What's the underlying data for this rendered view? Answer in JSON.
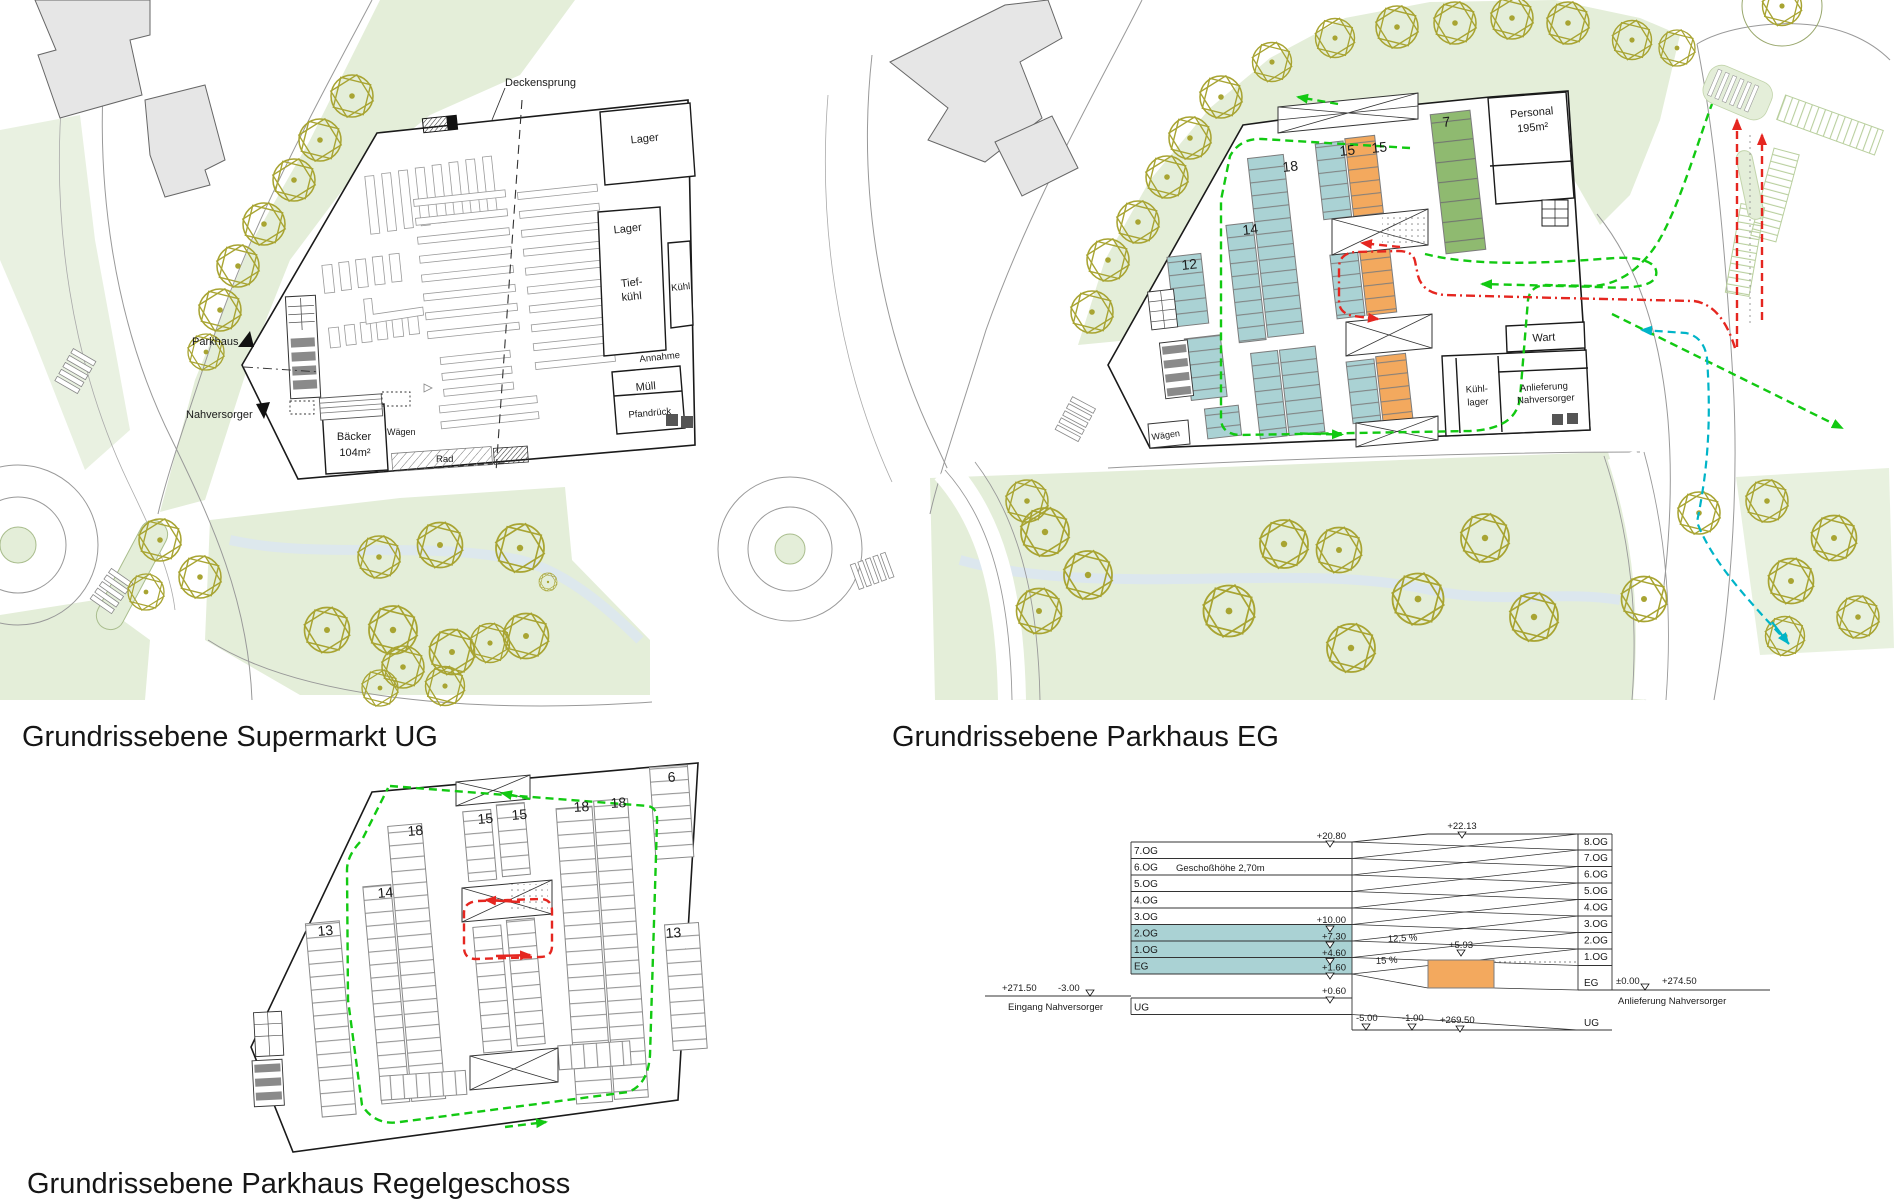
{
  "colors": {
    "stall_teal": "#aad2d4",
    "stall_orange": "#f3a95e",
    "stall_green": "#8fba70",
    "landscape_green": "#e4eed9",
    "tree_olive": "#a8a432",
    "route_green": "#12c912",
    "route_red": "#e52620",
    "route_cyan": "#00b4c8",
    "building_gray": "#e6e6e6",
    "line_black": "#1a1a1a"
  },
  "titles": {
    "supermarkt": "Grundrissebene Supermarkt UG",
    "parkhaus_eg": "Grundrissebene Parkhaus EG",
    "parkhaus_regel": "Grundrissebene Parkhaus Regelgeschoss"
  },
  "supermarkt": {
    "deckensprung": "Deckensprung",
    "lager_top": "Lager",
    "lager_mid": "Lager",
    "tief": "Tief-",
    "kuehl_unten": "kühl",
    "kuehl": "Kühl",
    "annahme": "Annahme",
    "muell": "Müll",
    "pfandrueck": "Pfandrück",
    "baecker": "Bäcker",
    "baecker_flaeche": "104m²",
    "waegen": "Wägen",
    "rad": "Rad",
    "richtung_parkhaus": "Parkhaus",
    "richtung_nahversorger": "Nahversorger"
  },
  "parkhaus_eg": {
    "c18": "18",
    "c15a": "15",
    "c15b": "15",
    "c7": "7",
    "c14": "14",
    "c12": "12",
    "personal": "Personal",
    "personal_flaeche": "195m²",
    "wart": "Wart",
    "kuehllager_1": "Kühl-",
    "kuehllager_2": "lager",
    "anlieferung_1": "Anlieferung",
    "anlieferung_2": "Nahversorger",
    "waegen": "Wägen"
  },
  "parkhaus_regel": {
    "c6": "6",
    "c18a": "18",
    "c15a": "15",
    "c15b": "15",
    "c18b": "18",
    "c18c": "18",
    "c14": "14",
    "c13a": "13",
    "c13b": "13"
  },
  "section": {
    "left_floors": [
      "7.OG",
      "6.OG",
      "5.OG",
      "4.OG",
      "3.OG",
      "2.OG",
      "1.OG",
      "EG",
      "UG"
    ],
    "right_floors": [
      "8.OG",
      "7.OG",
      "6.OG",
      "5.OG",
      "4.OG",
      "3.OG",
      "2.OG",
      "1.OG",
      "EG",
      "UG"
    ],
    "geschosshoehe": "Geschoßhöhe 2,70m",
    "elev_links_oben": "+20.80",
    "elev_rechts_oben": "+22.13",
    "elev_3og": "+10.00",
    "elev_2og": "+7.30",
    "elev_1og": "+4.60",
    "elev_eg": "+1.60",
    "elev_ug": "+0.60",
    "elev_rampe": "+5.93",
    "steigung_1": "12,5 %",
    "steigung_2": "15 %",
    "links_hoehe": "+271.50",
    "links_tiefe": "-3.00",
    "links_text": "Eingang Nahversorger",
    "rechts_null": "±0.00",
    "rechts_hoehe": "+274.50",
    "rechts_text": "Anlieferung Nahversorger",
    "unten_1": "-5.00",
    "unten_2": "-1.00",
    "unten_3": "+269.50"
  }
}
